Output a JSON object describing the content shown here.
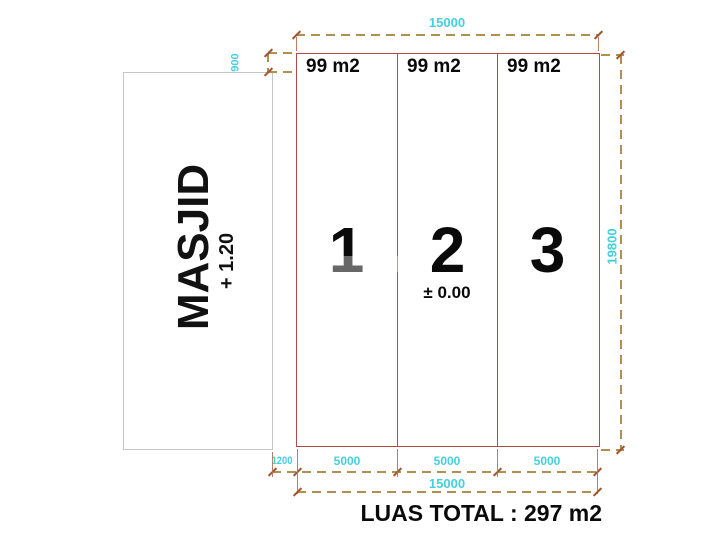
{
  "masjid": {
    "label": "MASJID",
    "elevation": "+ 1.20"
  },
  "plots": [
    {
      "number": "1",
      "area": "99 m2"
    },
    {
      "number": "2",
      "area": "99 m2",
      "elevation": "± 0.00"
    },
    {
      "number": "3",
      "area": "99 m2"
    }
  ],
  "dimensions": {
    "top_width": "15000",
    "masjid_top_offset": "900",
    "right_height": "19800",
    "bottom_segments": [
      "1200",
      "5000",
      "5000",
      "5000"
    ],
    "bottom_total": "15000"
  },
  "luas_total": "LUAS TOTAL :  297 m2",
  "colors": {
    "plot_outline": "#b34a4a",
    "masjid_outline": "#c6c6c6",
    "dimension_text": "#45d0dd",
    "dimension_dash": "#b09050",
    "dimension_tick": "#a4542c",
    "drawing_text": "#0a0a0a",
    "background": "#ffffff"
  }
}
